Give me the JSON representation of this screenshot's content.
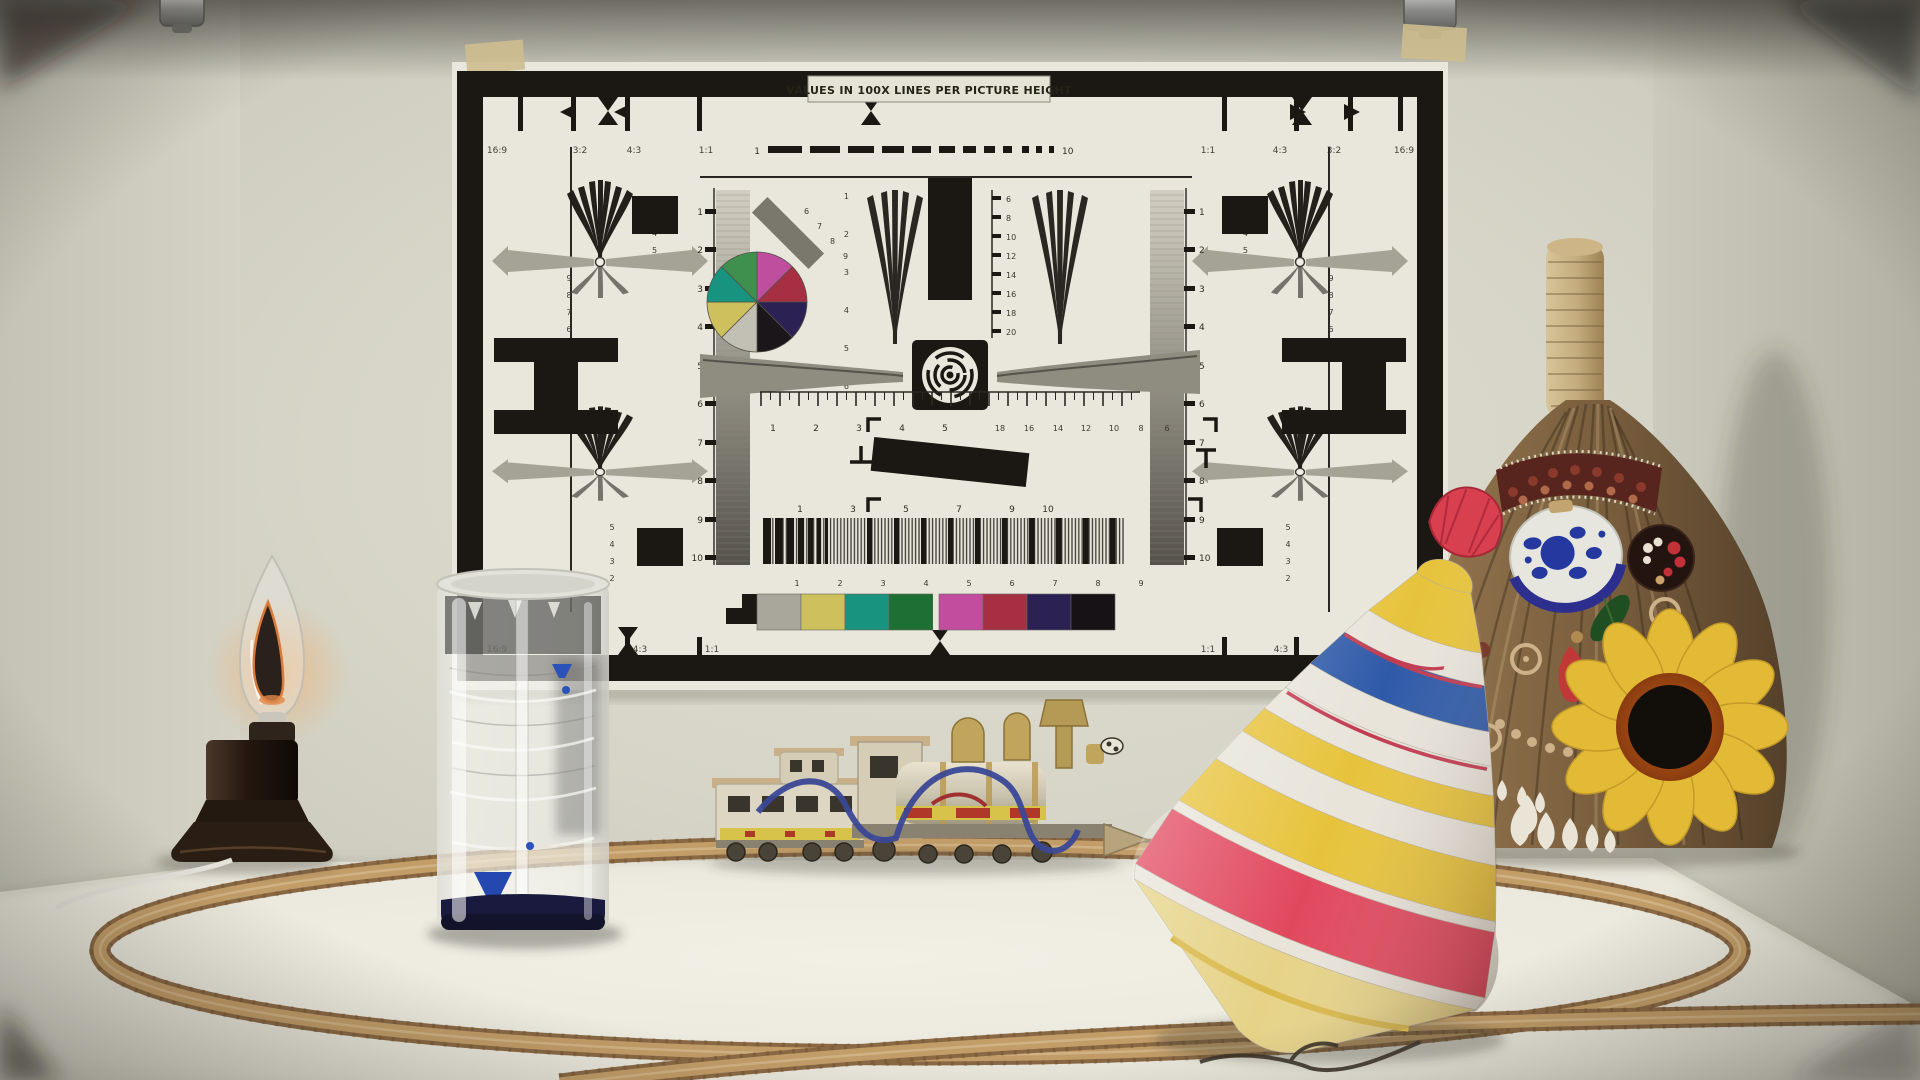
{
  "chart": {
    "title": "VALUES IN 100X LINES PER PICTURE HEIGHT",
    "aspects": [
      "16:9",
      "3:2",
      "4:3",
      "1:1"
    ],
    "v_scale": [
      "1",
      "2",
      "3",
      "4",
      "5",
      "6",
      "7",
      "8",
      "9",
      "10"
    ],
    "center_right_scale": [
      "6",
      "8",
      "10",
      "12",
      "14",
      "16",
      "18",
      "20"
    ],
    "wedge_scale": [
      "1",
      "2",
      "3",
      "4",
      "5",
      "6"
    ],
    "diag_scale": [
      "6",
      "7",
      "8",
      "9"
    ],
    "h_scale_left": [
      "1",
      "2",
      "3",
      "4",
      "5"
    ],
    "h_scale_right": [
      "18",
      "16",
      "14",
      "12",
      "10",
      "8",
      "6"
    ],
    "grating_scale_top": [
      "1",
      "3",
      "5",
      "7",
      "9",
      "10"
    ],
    "grating_scale_bottom": [
      "1",
      "2",
      "3",
      "4",
      "5",
      "6",
      "7",
      "8",
      "9"
    ],
    "dash_scale": {
      "start": "1",
      "end": "10"
    },
    "fan_tl_right": [
      "2",
      "3",
      "4",
      "5"
    ],
    "fan_tl_left": [
      "9",
      "8",
      "7",
      "6"
    ],
    "fan_bl": [
      "5",
      "4",
      "3",
      "2"
    ],
    "colorbar": [
      "#a9a79c",
      "#cfc05e",
      "#17937f",
      "#1d6f33",
      "#c24d9e",
      "#a62f44",
      "#2b2153",
      "#161216"
    ],
    "wheel": [
      "#bf4f9e",
      "#a62f44",
      "#2b2153",
      "#1a161a",
      "#c2bfb4",
      "#cfc05e",
      "#17937f",
      "#3f8f4f"
    ]
  },
  "palette": {
    "wall": "#d8d7cc",
    "left_wall": "#cccbc0",
    "right_wall": "#c3c2b5",
    "table": "#eeece2",
    "track": "#bf9a63",
    "chart_paper": "#e9e7db",
    "chart_ink": "#1b1813",
    "top_red": "#e1485e",
    "top_yellow": "#e7c33c",
    "top_blue": "#2f5aa8",
    "knob_pink": "#d8404f",
    "liquid_navy": "#1a1a3e",
    "droplet_blue": "#2a52b8",
    "broom_body": "#7c6247",
    "raffia": "#c9b48a",
    "sunflower": "#e2ba35",
    "plate_navy": "#2438a0",
    "train_gold": "#c2a55c",
    "wire_blue": "#3a4896"
  }
}
